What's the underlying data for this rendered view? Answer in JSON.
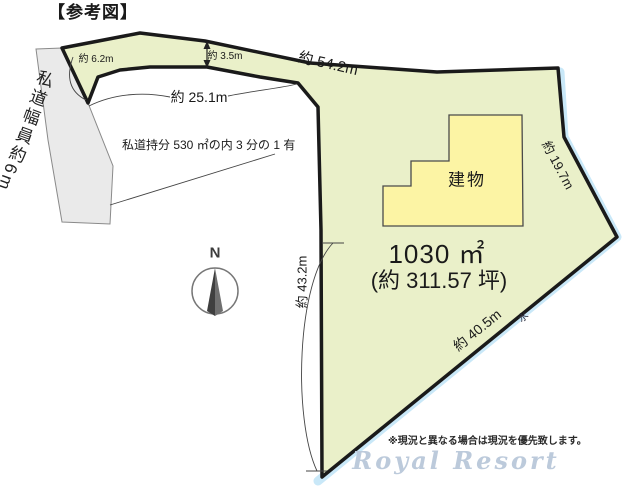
{
  "figure": {
    "title": "【参考図】",
    "road": {
      "label": "私道幅員約6m",
      "share_note": "私道持分 530 ㎡の内 3 分の 1 有"
    },
    "dimensions": {
      "left_end": "約 6.2m",
      "strip_width": "約 3.5m",
      "strip_length": "約 25.1m",
      "top_edge": "約 54.2m",
      "right_edge": "約 19.7m",
      "left_edge": "約 43.2m",
      "bottom_edge": "約 40.5m"
    },
    "building": {
      "label": "建物"
    },
    "area": {
      "square_meters": "1030 ㎡",
      "tsubo": "(約 311.57 坪)"
    },
    "water_label": "水",
    "compass": {
      "north": "N"
    },
    "footer": {
      "disclaimer": "※現況と異なる場合は現況を優先致します。",
      "watermark": "Royal Resort"
    },
    "colors": {
      "plot_fill": "#eaf0c9",
      "building_fill": "#fcf4a4",
      "road_fill": "#eaeaea",
      "water_band": "#c9e8f8",
      "outline": "#1a1a1a"
    }
  }
}
